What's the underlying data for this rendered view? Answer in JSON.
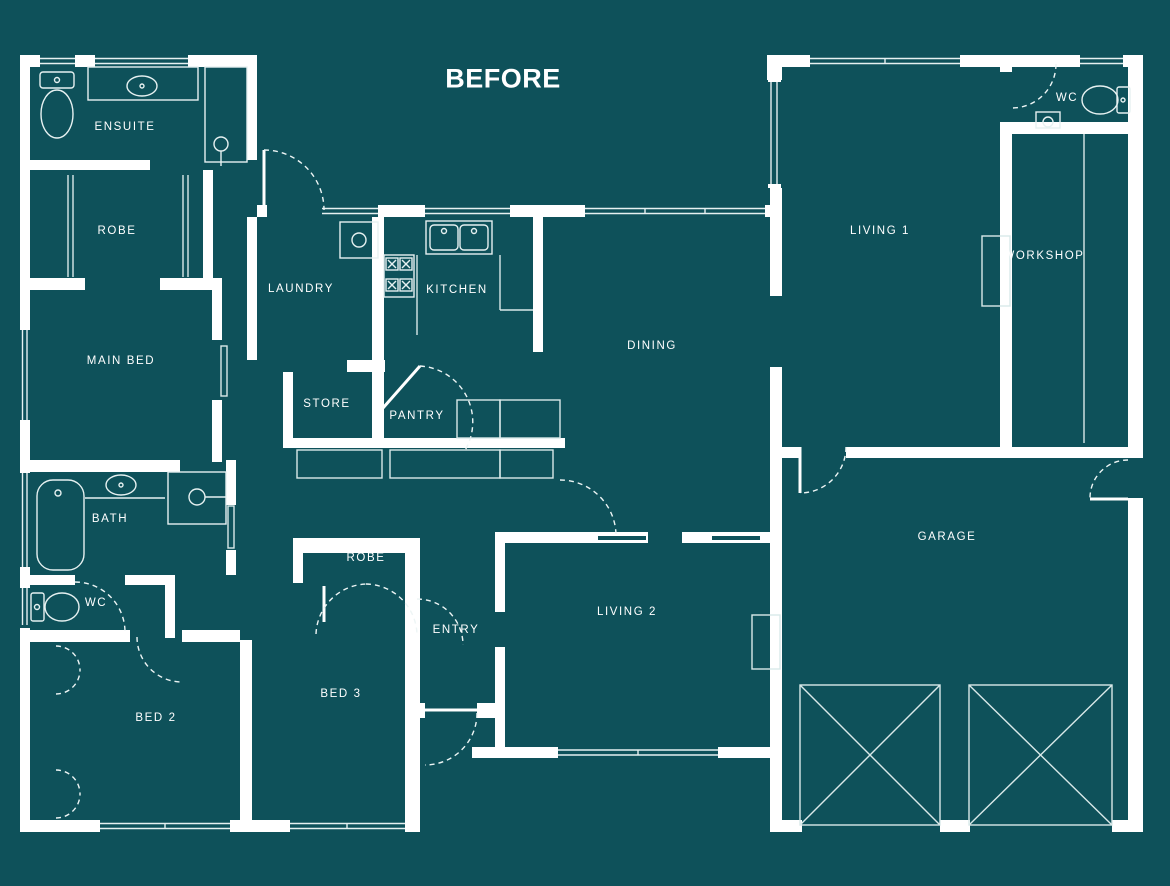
{
  "title": {
    "text": "BEFORE"
  },
  "colors": {
    "background": "#0E515A",
    "wall": "#FFFFFF",
    "thin_line": "#D9E9E9",
    "dashed_line": "#EDF5F5",
    "label_text": "#FFFFFF"
  },
  "rooms": [
    {
      "id": "ensuite",
      "label": "ENSUITE"
    },
    {
      "id": "robe-main",
      "label": "ROBE"
    },
    {
      "id": "main-bed",
      "label": "MAIN BED"
    },
    {
      "id": "laundry",
      "label": "LAUNDRY"
    },
    {
      "id": "kitchen",
      "label": "KITCHEN"
    },
    {
      "id": "dining",
      "label": "DINING"
    },
    {
      "id": "living-1",
      "label": "LIVING 1"
    },
    {
      "id": "workshop",
      "label": "WORKSHOP"
    },
    {
      "id": "wc-right",
      "label": "WC"
    },
    {
      "id": "store",
      "label": "STORE"
    },
    {
      "id": "pantry",
      "label": "PANTRY"
    },
    {
      "id": "garage",
      "label": "GARAGE"
    },
    {
      "id": "bath",
      "label": "BATH"
    },
    {
      "id": "wc-left",
      "label": "WC"
    },
    {
      "id": "robe-bed3",
      "label": "ROBE"
    },
    {
      "id": "entry",
      "label": "ENTRY"
    },
    {
      "id": "living-2",
      "label": "LIVING 2"
    },
    {
      "id": "bed-2",
      "label": "BED 2"
    },
    {
      "id": "bed-3",
      "label": "BED 3"
    }
  ],
  "fixtures": [
    "toilet",
    "vanity-basin",
    "shower",
    "bathtub",
    "laundry-tub",
    "kitchen-sink",
    "cooktop",
    "wardrobe-rail",
    "fireplace",
    "workshop-bench",
    "garage-panel",
    "linen-cupboard"
  ]
}
